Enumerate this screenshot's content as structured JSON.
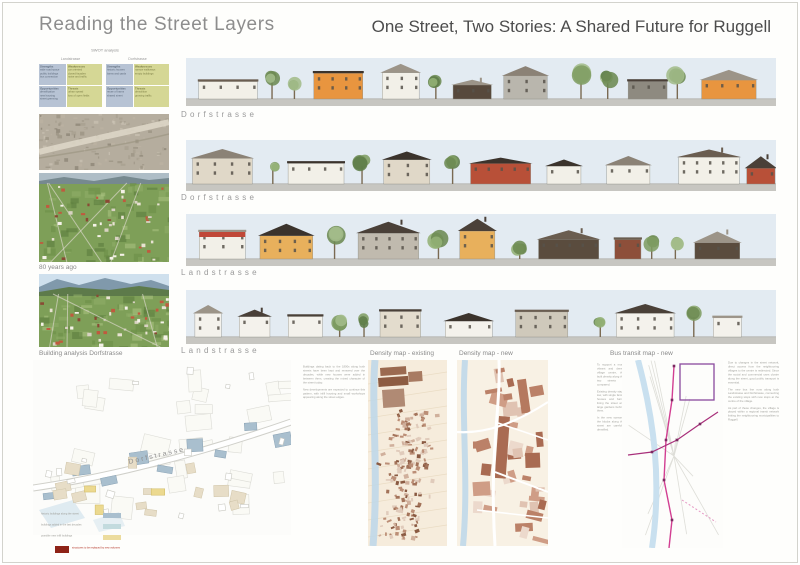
{
  "header": {
    "title_left": "Reading the Street Layers",
    "title_right": "One Street, Two Stories: A Shared Future for Ruggell"
  },
  "swot": {
    "title": "SWOT analysis",
    "quadrants": [
      "Strengths",
      "Weaknesses",
      "Opportunities",
      "Threats"
    ],
    "columns": [
      {
        "name": "Landstrasse",
        "strengths": [
          "wide road space",
          "public buildings",
          "bus connection"
        ],
        "weaknesses": [
          "car oriented",
          "closed facades",
          "noise and traffic"
        ],
        "opportunities": [
          "densification",
          "new housing",
          "street greening"
        ],
        "threats": [
          "urban sprawl",
          "loss of open fields"
        ]
      },
      {
        "name": "Dorfstrasse",
        "strengths": [
          "historic houses",
          "barns and yards"
        ],
        "weaknesses": [
          "narrow walkways",
          "empty buildings"
        ],
        "opportunities": [
          "reuse of barns",
          "shared street"
        ],
        "threats": [
          "demolition",
          "growing traffic"
        ]
      }
    ]
  },
  "left_column": {
    "photo_caption": "80 years ago",
    "building_analysis_label": "Building analysis Dorfstrasse",
    "map_street_label": "Dorfstrasse",
    "legend": [
      {
        "label": "historic buildings along the street",
        "color": "#a9bfce"
      },
      {
        "label": "buildings added in the last decades",
        "color": "#c3dbde"
      },
      {
        "label": "possible new infill buildings",
        "color": "#ecdc9e"
      }
    ],
    "legend_note": {
      "label": "structures to be replaced by new volumes",
      "color": "#8e2317"
    }
  },
  "elevations": [
    {
      "label": "Dorfstrasse"
    },
    {
      "label": "Dorfstrasse"
    },
    {
      "label": "Landstrasse"
    },
    {
      "label": "Landstrasse"
    }
  ],
  "bottom": {
    "captions": {
      "existing": "Density map - existing",
      "new": "Density map - new",
      "bus": "Bus transit map - new"
    },
    "text_col1": [
      "Buildings dating back to the 1800s along both streets have been kept and renewed over the decades, while new houses were added in between them, creating the mixed character of the street today.",
      "New developments are expected to continue this pattern, with infill housing and small workshops appearing along the street edges."
    ],
    "text_col2": [
      "To support a more vibrant and dense village centre, the built density along the two streets is compared.",
      "Existing density stays low, with single family houses and barns lining the street and large gardens behind them.",
      "In the new scenario the blocks along the street are carefully densified."
    ],
    "text_col3": [
      "Due to changes in the street network, direct access from the neighbouring villages to the centre is redirected. Since the social and commercial uses cluster along the street, good public transport is essential.",
      "The new bus line runs along both Landstrasse and Dorfstrasse, connecting the existing stops with new stops at the centre of the village.",
      "As part of these changes, the village is placed within a regional transit network linking the neighbouring municipalities to Ruggell."
    ]
  },
  "colors": {
    "sky": "#e3ebf2",
    "ground": "#c7c6c1",
    "swot_blue": "#b7c3d4",
    "swot_green": "#d5d795",
    "density_paper": "#f6ecdc",
    "density_brown": "#a96b52",
    "river_blue": "#bcd7ea",
    "bus_route_pink": "#d23f92",
    "bus_zone_purple": "#8b4a9e"
  }
}
